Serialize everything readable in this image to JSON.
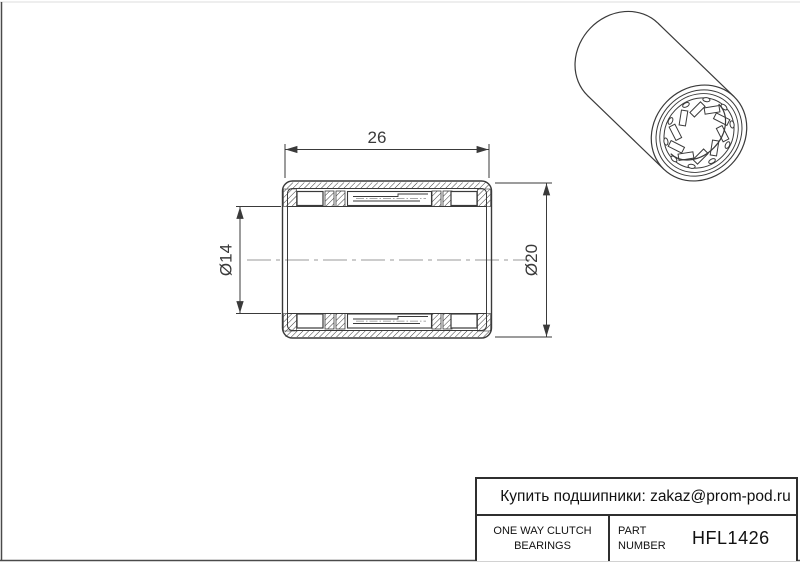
{
  "page": {
    "background": "#ffffff",
    "line_color": "#3a3a3a",
    "centerline_color": "#999999",
    "frame_color": "#4a4a4a"
  },
  "drawing": {
    "dim_width": {
      "label": "26"
    },
    "dim_bore": {
      "label": "Ø14"
    },
    "dim_outer": {
      "label": "Ø20"
    }
  },
  "title_block": {
    "contact": "Купить подшипники: zakaz@prom-pod.ru",
    "product_line1": "ONE WAY CLUTCH",
    "product_line2": "BEARINGS",
    "part_label_line1": "PART",
    "part_label_line2": "NUMBER",
    "part_number": "HFL1426"
  }
}
